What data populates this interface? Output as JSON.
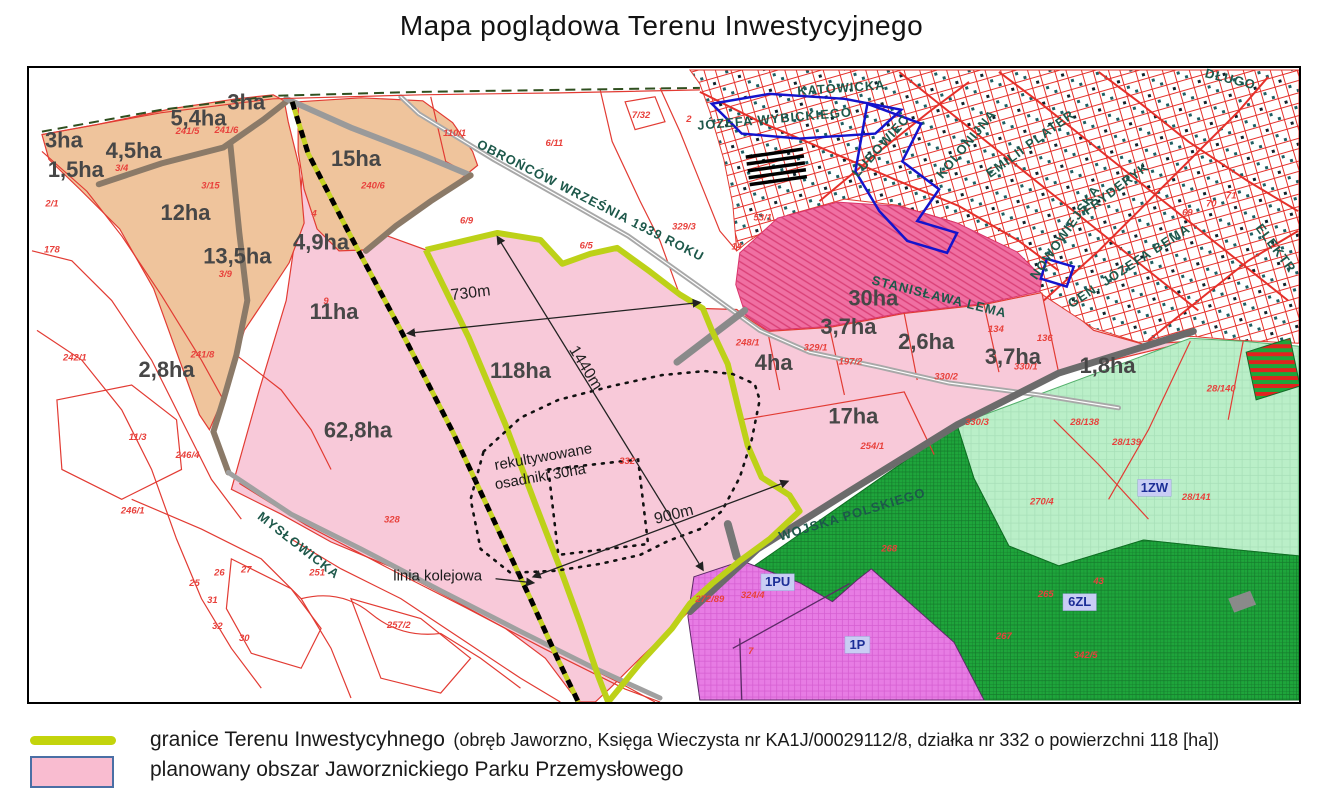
{
  "title": "Mapa poglądowa Terenu Inwestycyjnego",
  "colors": {
    "investment_boundary": "#c3d40c",
    "planned_park_pink": "#f8c9d9",
    "orange_area": "#efc49c",
    "dark_pink_30ha": "#f06fa2",
    "light_green_1zw": "#baefc8",
    "dark_green_forest": "#1ea53b",
    "purple_1pu": "#e77ce4",
    "cadastral_red": "#e8251f",
    "urban_blue": "#1414cc",
    "railway_black": "#000000"
  },
  "map": {
    "area_labels": [
      {
        "t": "3ha",
        "x": 62,
        "y": 140,
        "s": 22
      },
      {
        "t": "5,4ha",
        "x": 197,
        "y": 118,
        "s": 22
      },
      {
        "t": "3ha",
        "x": 245,
        "y": 102,
        "s": 22
      },
      {
        "t": "4,5ha",
        "x": 132,
        "y": 151,
        "s": 22
      },
      {
        "t": "1,5ha",
        "x": 74,
        "y": 170,
        "s": 22
      },
      {
        "t": "12ha",
        "x": 184,
        "y": 213,
        "s": 24
      },
      {
        "t": "13,5ha",
        "x": 236,
        "y": 257,
        "s": 24
      },
      {
        "t": "15ha",
        "x": 355,
        "y": 159,
        "s": 26
      },
      {
        "t": "4,9ha",
        "x": 320,
        "y": 243,
        "s": 22
      },
      {
        "t": "11ha",
        "x": 333,
        "y": 313,
        "s": 24
      },
      {
        "t": "2,8ha",
        "x": 165,
        "y": 371,
        "s": 22
      },
      {
        "t": "62,8ha",
        "x": 357,
        "y": 432,
        "s": 28
      },
      {
        "t": "118ha",
        "x": 520,
        "y": 372,
        "s": 30
      },
      {
        "t": "30ha",
        "x": 874,
        "y": 299,
        "s": 27
      },
      {
        "t": "3,7ha",
        "x": 849,
        "y": 328,
        "s": 22
      },
      {
        "t": "2,6ha",
        "x": 927,
        "y": 343,
        "s": 22
      },
      {
        "t": "4ha",
        "x": 774,
        "y": 364,
        "s": 24
      },
      {
        "t": "3,7ha",
        "x": 1014,
        "y": 358,
        "s": 22
      },
      {
        "t": "1,8ha",
        "x": 1109,
        "y": 367,
        "s": 22
      },
      {
        "t": "17ha",
        "x": 854,
        "y": 418,
        "s": 24
      }
    ],
    "street_labels": [
      {
        "t": "OBROŃCÓW WRZEŚNIA 1939 ROKU",
        "x": 590,
        "y": 200,
        "r": 27,
        "s": 13
      },
      {
        "t": "KATOWICKA",
        "x": 842,
        "y": 87,
        "r": -4,
        "s": 13
      },
      {
        "t": "JÓZEFA WYBICKIEGO",
        "x": 775,
        "y": 118,
        "r": -5,
        "s": 13
      },
      {
        "t": "LUBOWIEC",
        "x": 882,
        "y": 145,
        "r": -48,
        "s": 12
      },
      {
        "t": "KOLONIJNA",
        "x": 968,
        "y": 143,
        "r": -50,
        "s": 12
      },
      {
        "t": "EMILII PLATER",
        "x": 1032,
        "y": 143,
        "r": -36,
        "s": 12
      },
      {
        "t": "NOWOWIEJSKA",
        "x": 1067,
        "y": 232,
        "r": -55,
        "s": 12
      },
      {
        "t": "FRYDERYK",
        "x": 1118,
        "y": 188,
        "r": -37,
        "s": 12
      },
      {
        "t": "GEN. JÓZEFA BEMA",
        "x": 1131,
        "y": 266,
        "r": -33,
        "s": 13
      },
      {
        "t": "ELEKTR",
        "x": 1277,
        "y": 248,
        "r": 53,
        "s": 12
      },
      {
        "t": "DŁUGO",
        "x": 1232,
        "y": 78,
        "r": 14,
        "s": 12
      },
      {
        "t": "STANISŁAWA LEMA",
        "x": 940,
        "y": 297,
        "r": 14,
        "s": 13,
        "c": "#6d5d85"
      },
      {
        "t": "MYSŁOWICKA",
        "x": 297,
        "y": 547,
        "r": 38,
        "s": 13
      },
      {
        "t": "WOJSKA POLSKIEGO",
        "x": 853,
        "y": 516,
        "r": -17,
        "s": 13
      }
    ],
    "parcel_labels": [
      {
        "t": "241/5",
        "x": 186,
        "y": 130
      },
      {
        "t": "241/6",
        "x": 225,
        "y": 129
      },
      {
        "t": "3/4",
        "x": 120,
        "y": 167
      },
      {
        "t": "3/15",
        "x": 209,
        "y": 185
      },
      {
        "t": "2/1",
        "x": 50,
        "y": 203
      },
      {
        "t": "178",
        "x": 50,
        "y": 249
      },
      {
        "t": "3/9",
        "x": 224,
        "y": 274
      },
      {
        "t": "240/6",
        "x": 372,
        "y": 185
      },
      {
        "t": "110/1",
        "x": 454,
        "y": 132
      },
      {
        "t": "6/11",
        "x": 554,
        "y": 142
      },
      {
        "t": "6/9",
        "x": 466,
        "y": 220
      },
      {
        "t": "6/5",
        "x": 586,
        "y": 245
      },
      {
        "t": "7/32",
        "x": 641,
        "y": 114
      },
      {
        "t": "2",
        "x": 689,
        "y": 118
      },
      {
        "t": "329/3",
        "x": 684,
        "y": 226
      },
      {
        "t": "53/1",
        "x": 763,
        "y": 217
      },
      {
        "t": "14",
        "x": 737,
        "y": 246
      },
      {
        "t": "4",
        "x": 313,
        "y": 213
      },
      {
        "t": "9",
        "x": 325,
        "y": 301
      },
      {
        "t": "242/1",
        "x": 73,
        "y": 358
      },
      {
        "t": "241/8",
        "x": 201,
        "y": 355
      },
      {
        "t": "11/3",
        "x": 136,
        "y": 438
      },
      {
        "t": "246/4",
        "x": 186,
        "y": 456
      },
      {
        "t": "246/1",
        "x": 131,
        "y": 512
      },
      {
        "t": "328",
        "x": 391,
        "y": 521
      },
      {
        "t": "332",
        "x": 627,
        "y": 462
      },
      {
        "t": "248/1",
        "x": 748,
        "y": 343
      },
      {
        "t": "329/1",
        "x": 816,
        "y": 348
      },
      {
        "t": "197/2",
        "x": 851,
        "y": 362
      },
      {
        "t": "330/2",
        "x": 947,
        "y": 377
      },
      {
        "t": "330/1",
        "x": 1027,
        "y": 367
      },
      {
        "t": "134",
        "x": 997,
        "y": 329
      },
      {
        "t": "136",
        "x": 1046,
        "y": 338
      },
      {
        "t": "330/3",
        "x": 978,
        "y": 423
      },
      {
        "t": "28/138",
        "x": 1086,
        "y": 423
      },
      {
        "t": "28/139",
        "x": 1128,
        "y": 443
      },
      {
        "t": "28/140",
        "x": 1223,
        "y": 389
      },
      {
        "t": "28/141",
        "x": 1198,
        "y": 498
      },
      {
        "t": "270/4",
        "x": 1043,
        "y": 503
      },
      {
        "t": "254/1",
        "x": 873,
        "y": 447
      },
      {
        "t": "257/2",
        "x": 398,
        "y": 627
      },
      {
        "t": "251",
        "x": 316,
        "y": 574
      },
      {
        "t": "26",
        "x": 218,
        "y": 574
      },
      {
        "t": "27",
        "x": 245,
        "y": 571
      },
      {
        "t": "25",
        "x": 193,
        "y": 585
      },
      {
        "t": "31",
        "x": 211,
        "y": 602
      },
      {
        "t": "32",
        "x": 216,
        "y": 628
      },
      {
        "t": "30",
        "x": 243,
        "y": 640
      },
      {
        "t": "324/4",
        "x": 753,
        "y": 597
      },
      {
        "t": "272/89",
        "x": 710,
        "y": 601
      },
      {
        "t": "7",
        "x": 751,
        "y": 653
      },
      {
        "t": "268",
        "x": 890,
        "y": 550
      },
      {
        "t": "265",
        "x": 1047,
        "y": 596
      },
      {
        "t": "43",
        "x": 1100,
        "y": 583
      },
      {
        "t": "267",
        "x": 1005,
        "y": 638
      },
      {
        "t": "342/5",
        "x": 1087,
        "y": 657
      },
      {
        "t": "69",
        "x": 1189,
        "y": 212
      },
      {
        "t": "70",
        "x": 1213,
        "y": 203
      },
      {
        "t": "71",
        "x": 1233,
        "y": 195
      }
    ],
    "zone_labels": [
      {
        "t": "1ZW",
        "x": 1156,
        "y": 489
      },
      {
        "t": "6ZL",
        "x": 1081,
        "y": 604
      },
      {
        "t": "1PU",
        "x": 778,
        "y": 584
      },
      {
        "t": "1P",
        "x": 858,
        "y": 647
      }
    ],
    "dimension_labels": [
      {
        "t": "730m",
        "x": 470,
        "y": 293,
        "r": -7,
        "s": 16
      },
      {
        "t": "1440m",
        "x": 585,
        "y": 368,
        "r": 58,
        "s": 16
      },
      {
        "t": "900m",
        "x": 674,
        "y": 516,
        "r": -14,
        "s": 16
      }
    ],
    "annotations": [
      {
        "t": "rekultywowane",
        "x": 543,
        "y": 458,
        "r": -10,
        "s": 15
      },
      {
        "t": "osadniki 30ha",
        "x": 540,
        "y": 478,
        "r": -10,
        "s": 15
      },
      {
        "t": "linia kolejowa",
        "x": 437,
        "y": 578,
        "r": 0,
        "s": 19
      }
    ]
  },
  "legend": {
    "items": [
      {
        "swatch": "line",
        "color": "#c3d40c",
        "label": "granice Terenu Inwestycyhnego",
        "detail": "(obręb Jaworzno, Księga Wieczysta nr KA1J/00029112/8,  działka nr 332 o powierzchni 118 [ha])"
      },
      {
        "swatch": "rect",
        "color": "#f9bcd0",
        "label": "planowany obszar Jaworznickiego Parku Przemysłowego",
        "detail": ""
      }
    ]
  }
}
